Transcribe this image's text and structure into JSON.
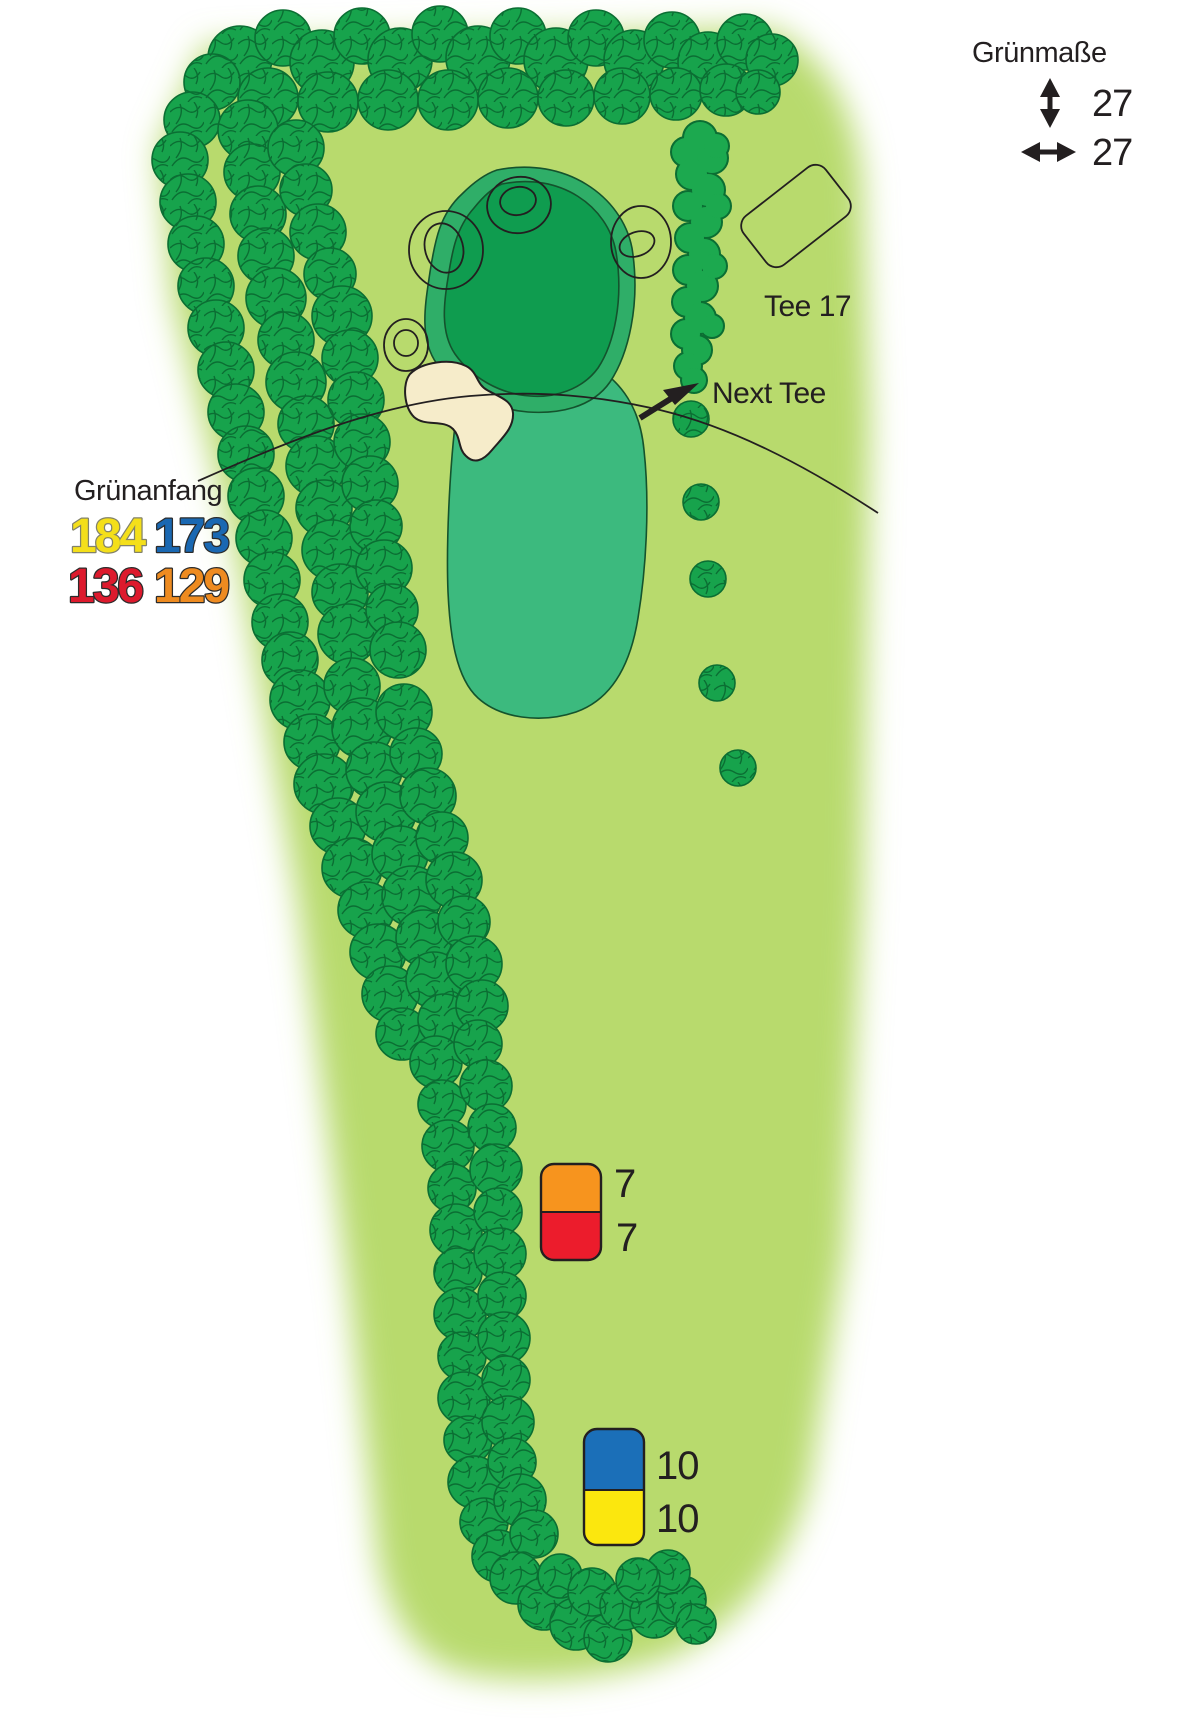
{
  "legend_green_size": {
    "title": "Grünmaße",
    "depth_value": "27",
    "width_value": "27"
  },
  "green_start": {
    "title": "Grünanfang",
    "yellow_value": "184",
    "blue_value": "173",
    "red_value": "136",
    "orange_value": "129"
  },
  "labels": {
    "tee": "Tee 17",
    "next_tee": "Next Tee"
  },
  "distance_markers": {
    "orange_red": {
      "orange_value": "7",
      "red_value": "7"
    },
    "blue_yellow": {
      "blue_value": "10",
      "yellow_value": "10"
    }
  },
  "colors": {
    "fairway": "#b8da6d",
    "canopy": "#17a34c",
    "canopy_line": "#0b6e33",
    "hedge": "#1ca94f",
    "apron": "#3cba7e",
    "fringe": "#2fae68",
    "green": "#0f9c4f",
    "green_line": "#14532d",
    "bunker": "#f6ecca",
    "outline": "#231f20",
    "text": "#231f20",
    "val_yellow": "#f4df1a",
    "val_yellow_line": "#82826a",
    "val_blue": "#1a68b2",
    "val_red": "#dd1a2d",
    "val_orange": "#ee8b20",
    "val_dark_line": "#2b2b2b",
    "marker_orange": "#f7941e",
    "marker_red": "#ec1c2c",
    "marker_blue": "#1b6fb8",
    "marker_yellow": "#fbe70e"
  }
}
